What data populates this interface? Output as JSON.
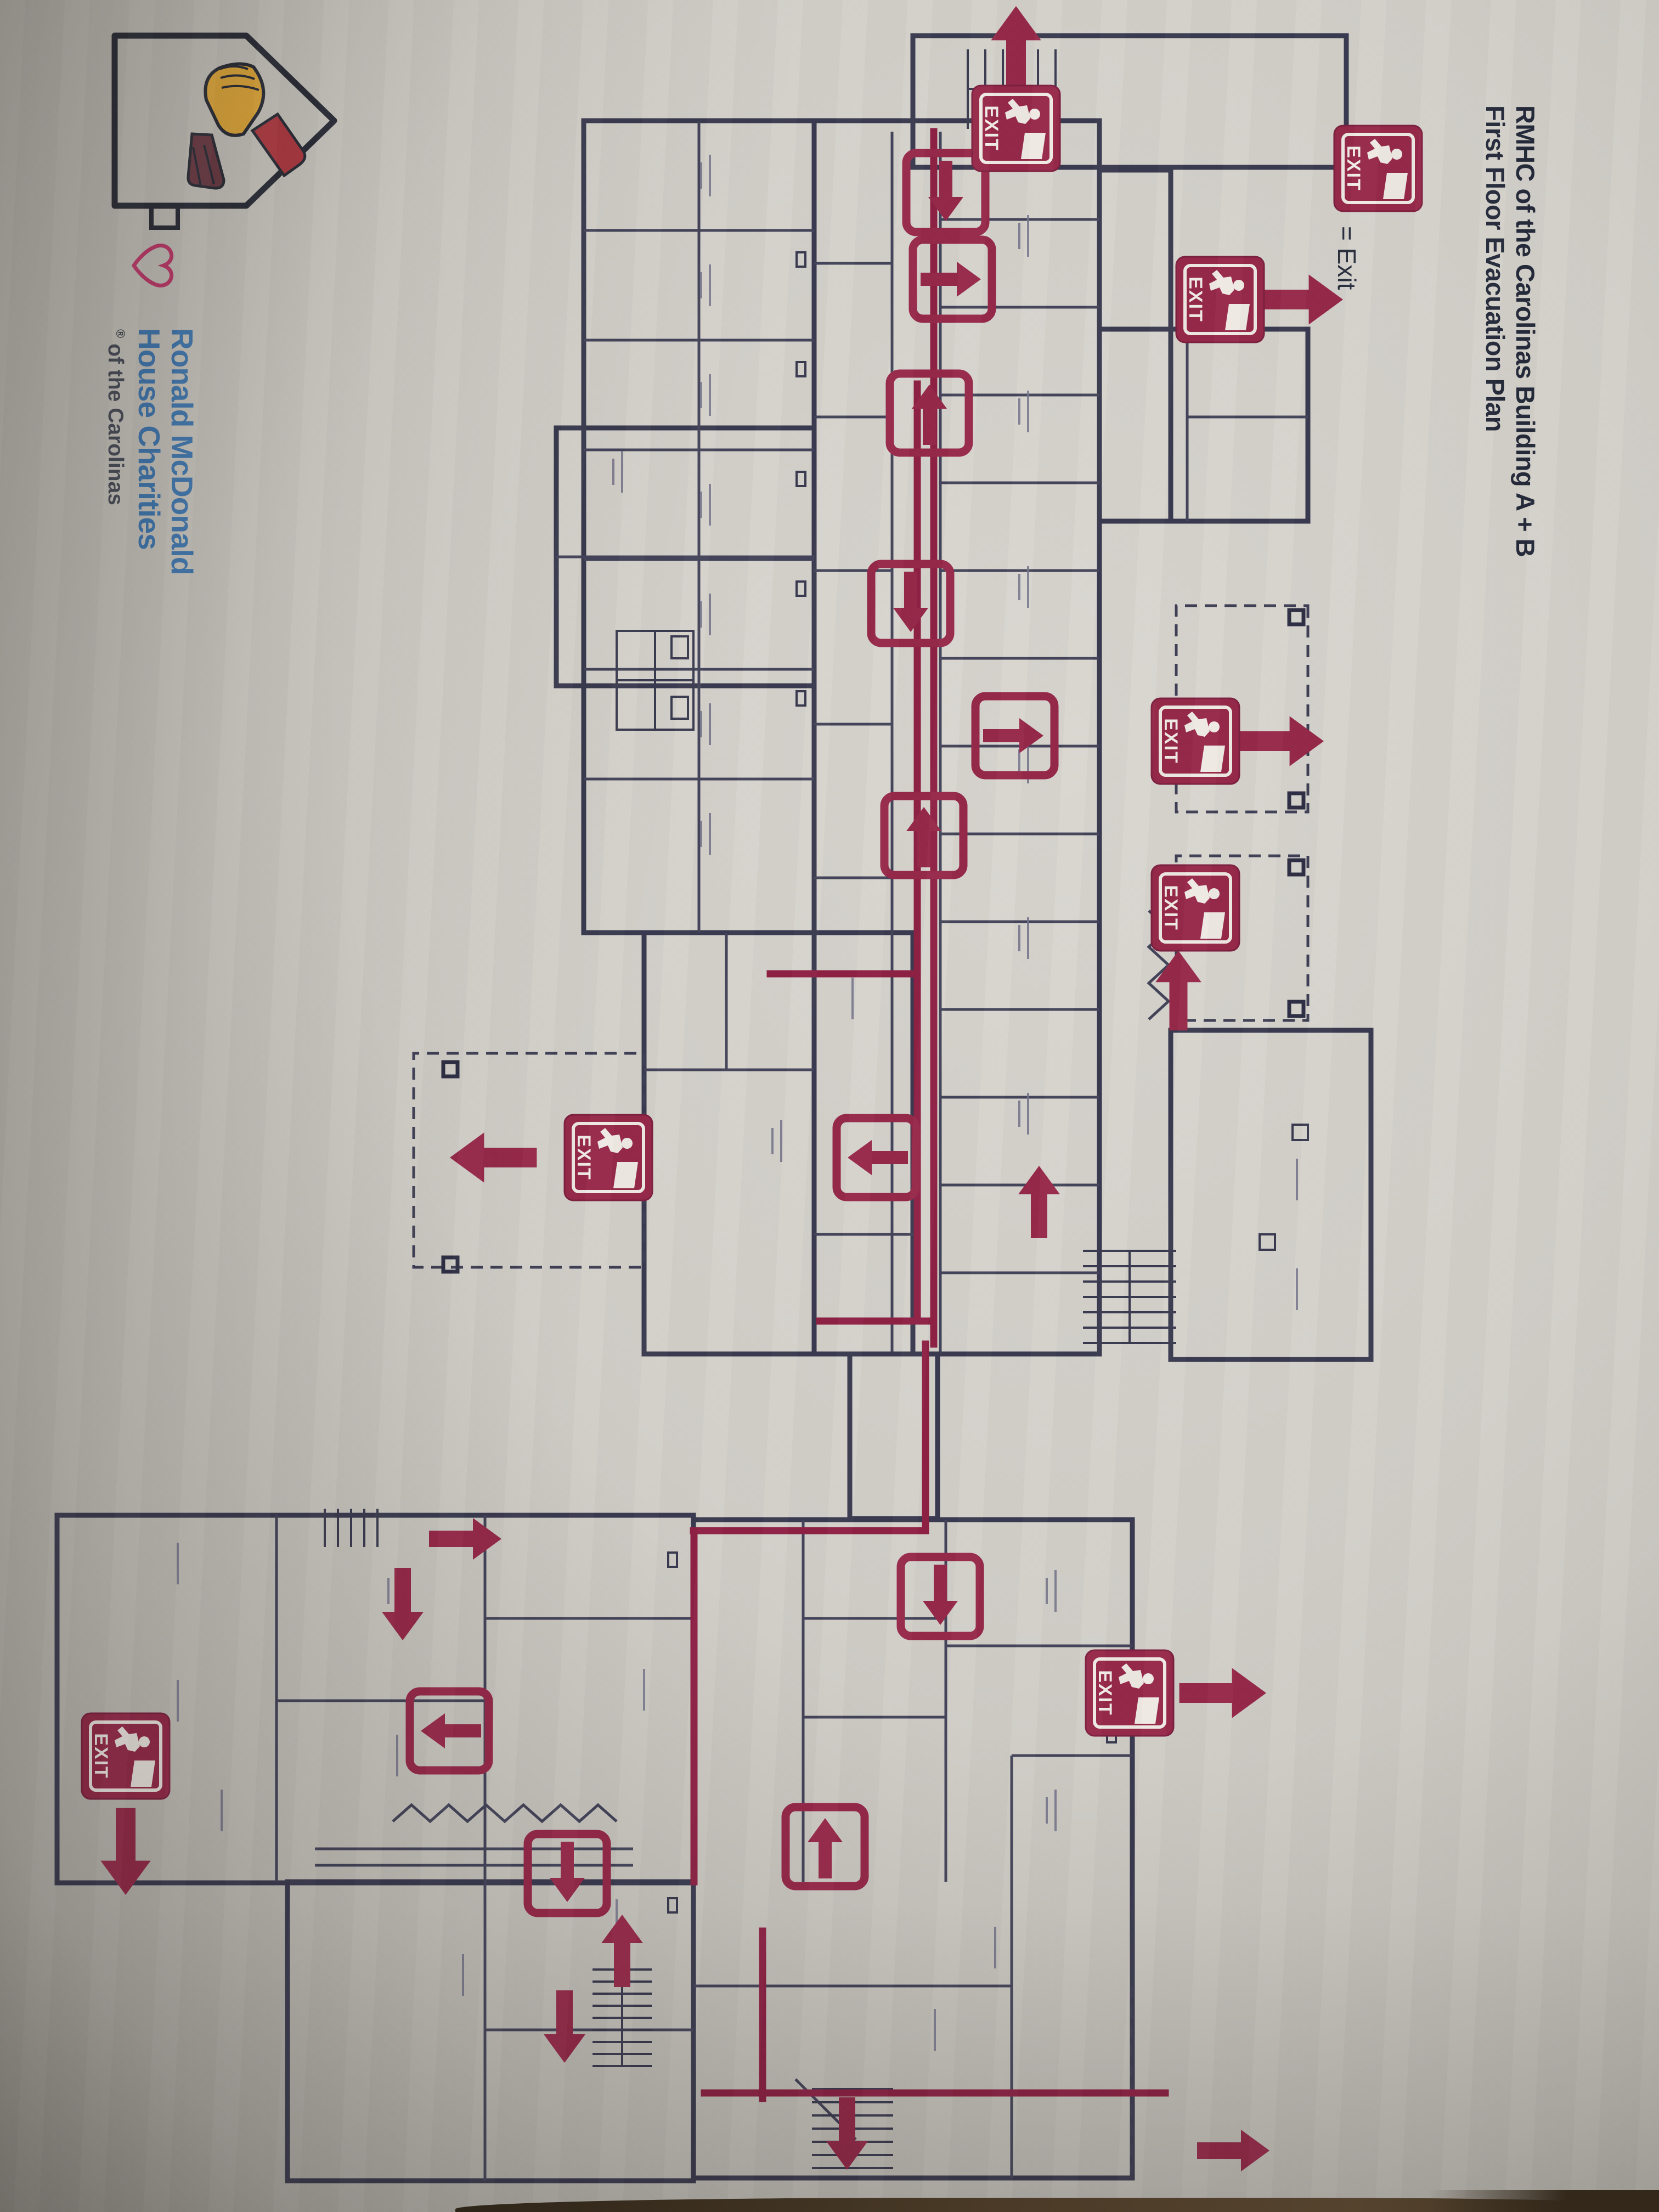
{
  "document": {
    "title_line1": "RMHC of the Carolinas Building A + B",
    "title_line2": "First Floor Evacuation Plan"
  },
  "legend": {
    "equals_label": "= Exit"
  },
  "exit_sign": {
    "label": "EXIT"
  },
  "logo": {
    "name_line1": "Ronald McDonald",
    "name_line2": "House Charities",
    "registered_mark": "®",
    "region_line": "of the Carolinas"
  },
  "colors": {
    "paper": "#d3d0ca",
    "wall_ink": "#3a3a50",
    "evac_red": "#97294a",
    "route_red": "#8e2145",
    "logo_blue": "#4079b2",
    "heart_pink": "#c23a6c",
    "glove_yellow": "#e2a93b",
    "sleeve_red": "#b03a42",
    "title_ink": "#252a3a",
    "table_brown": "#3b2f22"
  }
}
